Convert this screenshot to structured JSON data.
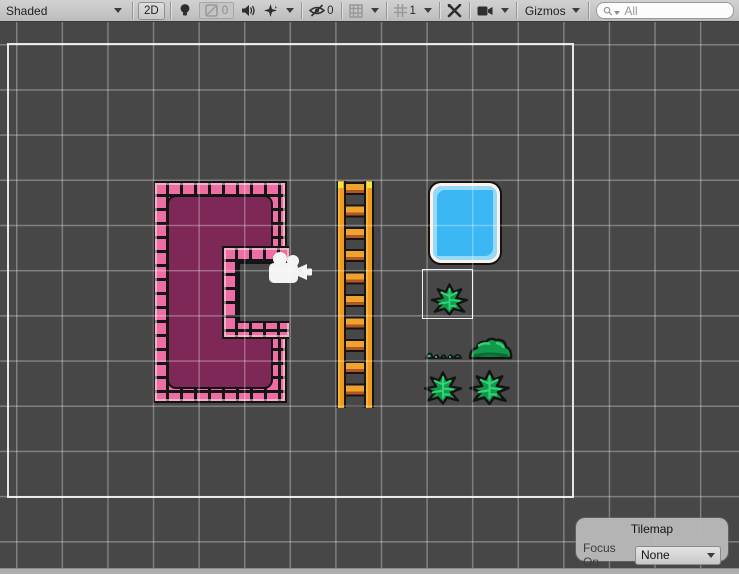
{
  "toolbar": {
    "draw_mode": "Shaded",
    "mode_2d": "2D",
    "exposure_value": "0",
    "hidden_count": "0",
    "grid_value": "1",
    "gizmos_label": "Gizmos",
    "search_placeholder": "All",
    "icons": [
      "dropdown-arrow",
      "light-bulb-icon",
      "scene-visibility-image-icon",
      "audio-icon",
      "effects-icon",
      "eye-slash-icon",
      "grid-paint-icon",
      "grid-snap-icon",
      "tools-icon",
      "camera-icon",
      "search-icon"
    ]
  },
  "scene": {
    "objects": [
      "pink-brick-room-tilemap",
      "orange-ladder",
      "water-tile",
      "selected-fern-bush",
      "grass-strip",
      "round-bush",
      "fern-bush",
      "fern-bush"
    ],
    "camera_gizmo": "camera-gizmo",
    "colors": {
      "viewport_background": "#474747",
      "grid_line": "#8c8c8c",
      "camera_bounds": "#fcfcfc",
      "room_fill": "#7d2856",
      "brick_pink": "#ee6da4",
      "brick_highlight": "#fae9e0",
      "ladder_orange": "#f09b1f",
      "ladder_shadow": "#b05627",
      "ladder_tip_yellow": "#f2ea3a",
      "water_blue": "#3bb7f3",
      "water_highlight": "#96daf8",
      "water_rim": "#fdf2ea",
      "bush_green": "#119a4a",
      "bush_highlight": "#35d377",
      "bush_shadow": "#0a6b33",
      "outline_black": "#131313"
    }
  },
  "tilemap_panel": {
    "title": "Tilemap",
    "focus_label": "Focus On",
    "focus_value": "None"
  }
}
